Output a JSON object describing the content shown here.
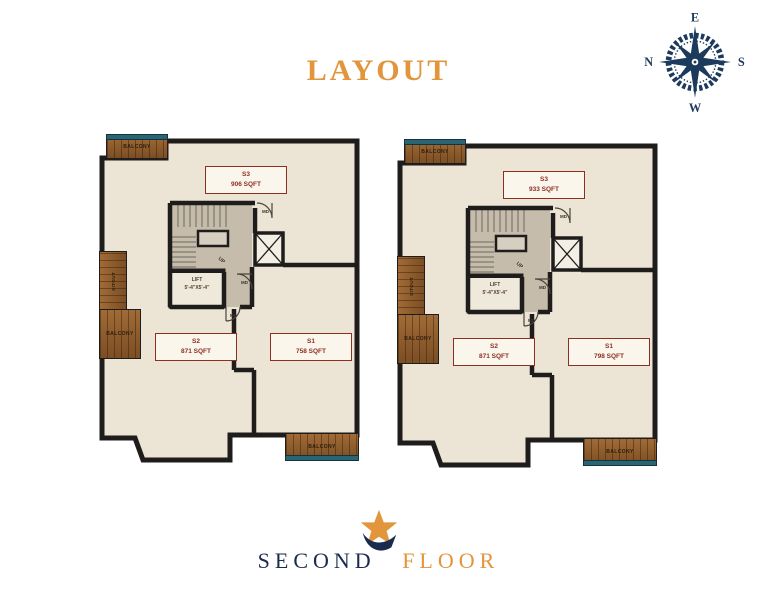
{
  "title": "LAYOUT",
  "compass": {
    "top": "E",
    "right": "S",
    "bottom": "W",
    "left": "N"
  },
  "footer": {
    "word1": "SECOND",
    "word2": "FLOOR"
  },
  "colors": {
    "accent_orange": "#E2953B",
    "navy": "#1C3A5C",
    "maroon": "#8C2F23",
    "teal": "#2A6573",
    "wall": "#1F1D1B",
    "floor": "#ECE4D4",
    "wood": "#8F5C2E"
  },
  "plans": [
    {
      "rooms": [
        {
          "id": "S3",
          "area": "906 SQFT"
        },
        {
          "id": "S2",
          "area": "871 SQFT"
        },
        {
          "id": "S1",
          "area": "758 SQFT"
        }
      ],
      "lift_label": "LIFT",
      "lift_size": "5'-4\"X5'-4\"",
      "balcony_top": "BALCONY",
      "sitout": "SITOUT",
      "balcony_left": "BALCONY",
      "balcony_bottom": "BALCONY",
      "up_label": "UP",
      "door_label": "MD"
    },
    {
      "rooms": [
        {
          "id": "S3",
          "area": "933 SQFT"
        },
        {
          "id": "S2",
          "area": "871 SQFT"
        },
        {
          "id": "S1",
          "area": "798 SQFT"
        }
      ],
      "lift_label": "LIFT",
      "lift_size": "5'-4\"X5'-4\"",
      "balcony_top": "BALCONY",
      "sitout": "SITOUT",
      "balcony_left": "BALCONY",
      "balcony_bottom": "BALCONY",
      "up_label": "UP",
      "door_label": "MD"
    }
  ]
}
